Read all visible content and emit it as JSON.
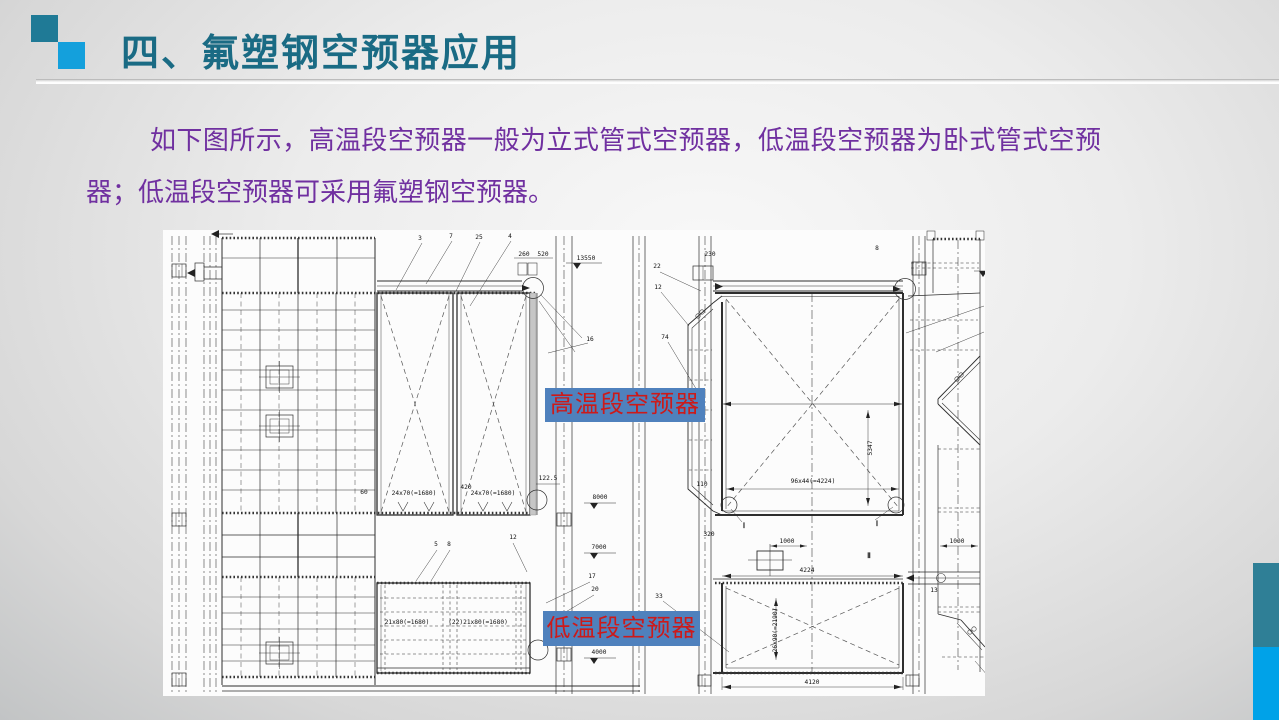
{
  "slide": {
    "title": "四、氟塑钢空预器应用",
    "paragraph": "如下图所示，高温段空预器一般为立式管式空预器，低温段空预器为卧式管式空预器；低温段空预器可采用氟塑钢空预器。",
    "labels": {
      "high_temp": "高温段空预器",
      "low_temp": "低温段空预器"
    }
  },
  "colors": {
    "title": "#1a6b84",
    "body_text": "#7030a0",
    "accent_square_back": "#1f7a96",
    "accent_square_front": "#14a0dc",
    "label_bg": "#4f81bd",
    "label_text": "#cc1a1a",
    "side_bar_teal": "#2f7f96",
    "side_bar_blue": "#00a2e8",
    "drawing_line": "#2e2e2e",
    "drawing_bg": "#fcfcfc"
  },
  "drawing": {
    "annotations": [
      {
        "t": "3",
        "x": 420,
        "y": 240
      },
      {
        "t": "7",
        "x": 451,
        "y": 238
      },
      {
        "t": "25",
        "x": 479,
        "y": 239
      },
      {
        "t": "4",
        "x": 510,
        "y": 238
      },
      {
        "t": "260",
        "x": 524,
        "y": 256
      },
      {
        "t": "520",
        "x": 543,
        "y": 256
      },
      {
        "t": "13550",
        "x": 586,
        "y": 260
      },
      {
        "t": "230",
        "x": 710,
        "y": 256
      },
      {
        "t": "8",
        "x": 877,
        "y": 250
      },
      {
        "t": "22",
        "x": 657,
        "y": 268
      },
      {
        "t": "12",
        "x": 658,
        "y": 289
      },
      {
        "t": "74",
        "x": 665,
        "y": 339
      },
      {
        "t": "16",
        "x": 590,
        "y": 341
      },
      {
        "t": "60",
        "x": 364,
        "y": 494
      },
      {
        "t": "24x70(=1680)",
        "x": 414,
        "y": 495
      },
      {
        "t": "420",
        "x": 466,
        "y": 489
      },
      {
        "t": "24x70(=1680)",
        "x": 493,
        "y": 495
      },
      {
        "t": "122.5",
        "x": 548,
        "y": 480
      },
      {
        "t": "8000",
        "x": 600,
        "y": 499
      },
      {
        "t": "7000",
        "x": 599,
        "y": 549
      },
      {
        "t": "4000",
        "x": 599,
        "y": 654
      },
      {
        "t": "17",
        "x": 592,
        "y": 578
      },
      {
        "t": "20",
        "x": 595,
        "y": 591
      },
      {
        "t": "5",
        "x": 436,
        "y": 546
      },
      {
        "t": "8",
        "x": 449,
        "y": 546
      },
      {
        "t": "12",
        "x": 513,
        "y": 539
      },
      {
        "t": "21x80(=1680)",
        "x": 407,
        "y": 624
      },
      {
        "t": "(22)21x80(=1680)",
        "x": 478,
        "y": 624
      },
      {
        "t": "110",
        "x": 702,
        "y": 486
      },
      {
        "t": "320",
        "x": 709,
        "y": 536
      },
      {
        "t": "33",
        "x": 659,
        "y": 598
      },
      {
        "t": "96x44(=4224)",
        "x": 813,
        "y": 483
      },
      {
        "t": "5347",
        "x": 872,
        "y": 448,
        "r": -90
      },
      {
        "t": "1000",
        "x": 787,
        "y": 543
      },
      {
        "t": "4224",
        "x": 807,
        "y": 572
      },
      {
        "t": "26x90(=2190)",
        "x": 777,
        "y": 630,
        "r": -90
      },
      {
        "t": "1000",
        "x": 957,
        "y": 543
      },
      {
        "t": "13",
        "x": 934,
        "y": 592
      },
      {
        "t": "4120",
        "x": 812,
        "y": 684
      },
      {
        "t": "Ⅰ",
        "x": 744,
        "y": 528,
        "b": 1
      },
      {
        "t": "Ⅰ",
        "x": 877,
        "y": 526,
        "b": 1
      },
      {
        "t": "Ⅱ",
        "x": 869,
        "y": 558,
        "b": 1
      }
    ]
  }
}
